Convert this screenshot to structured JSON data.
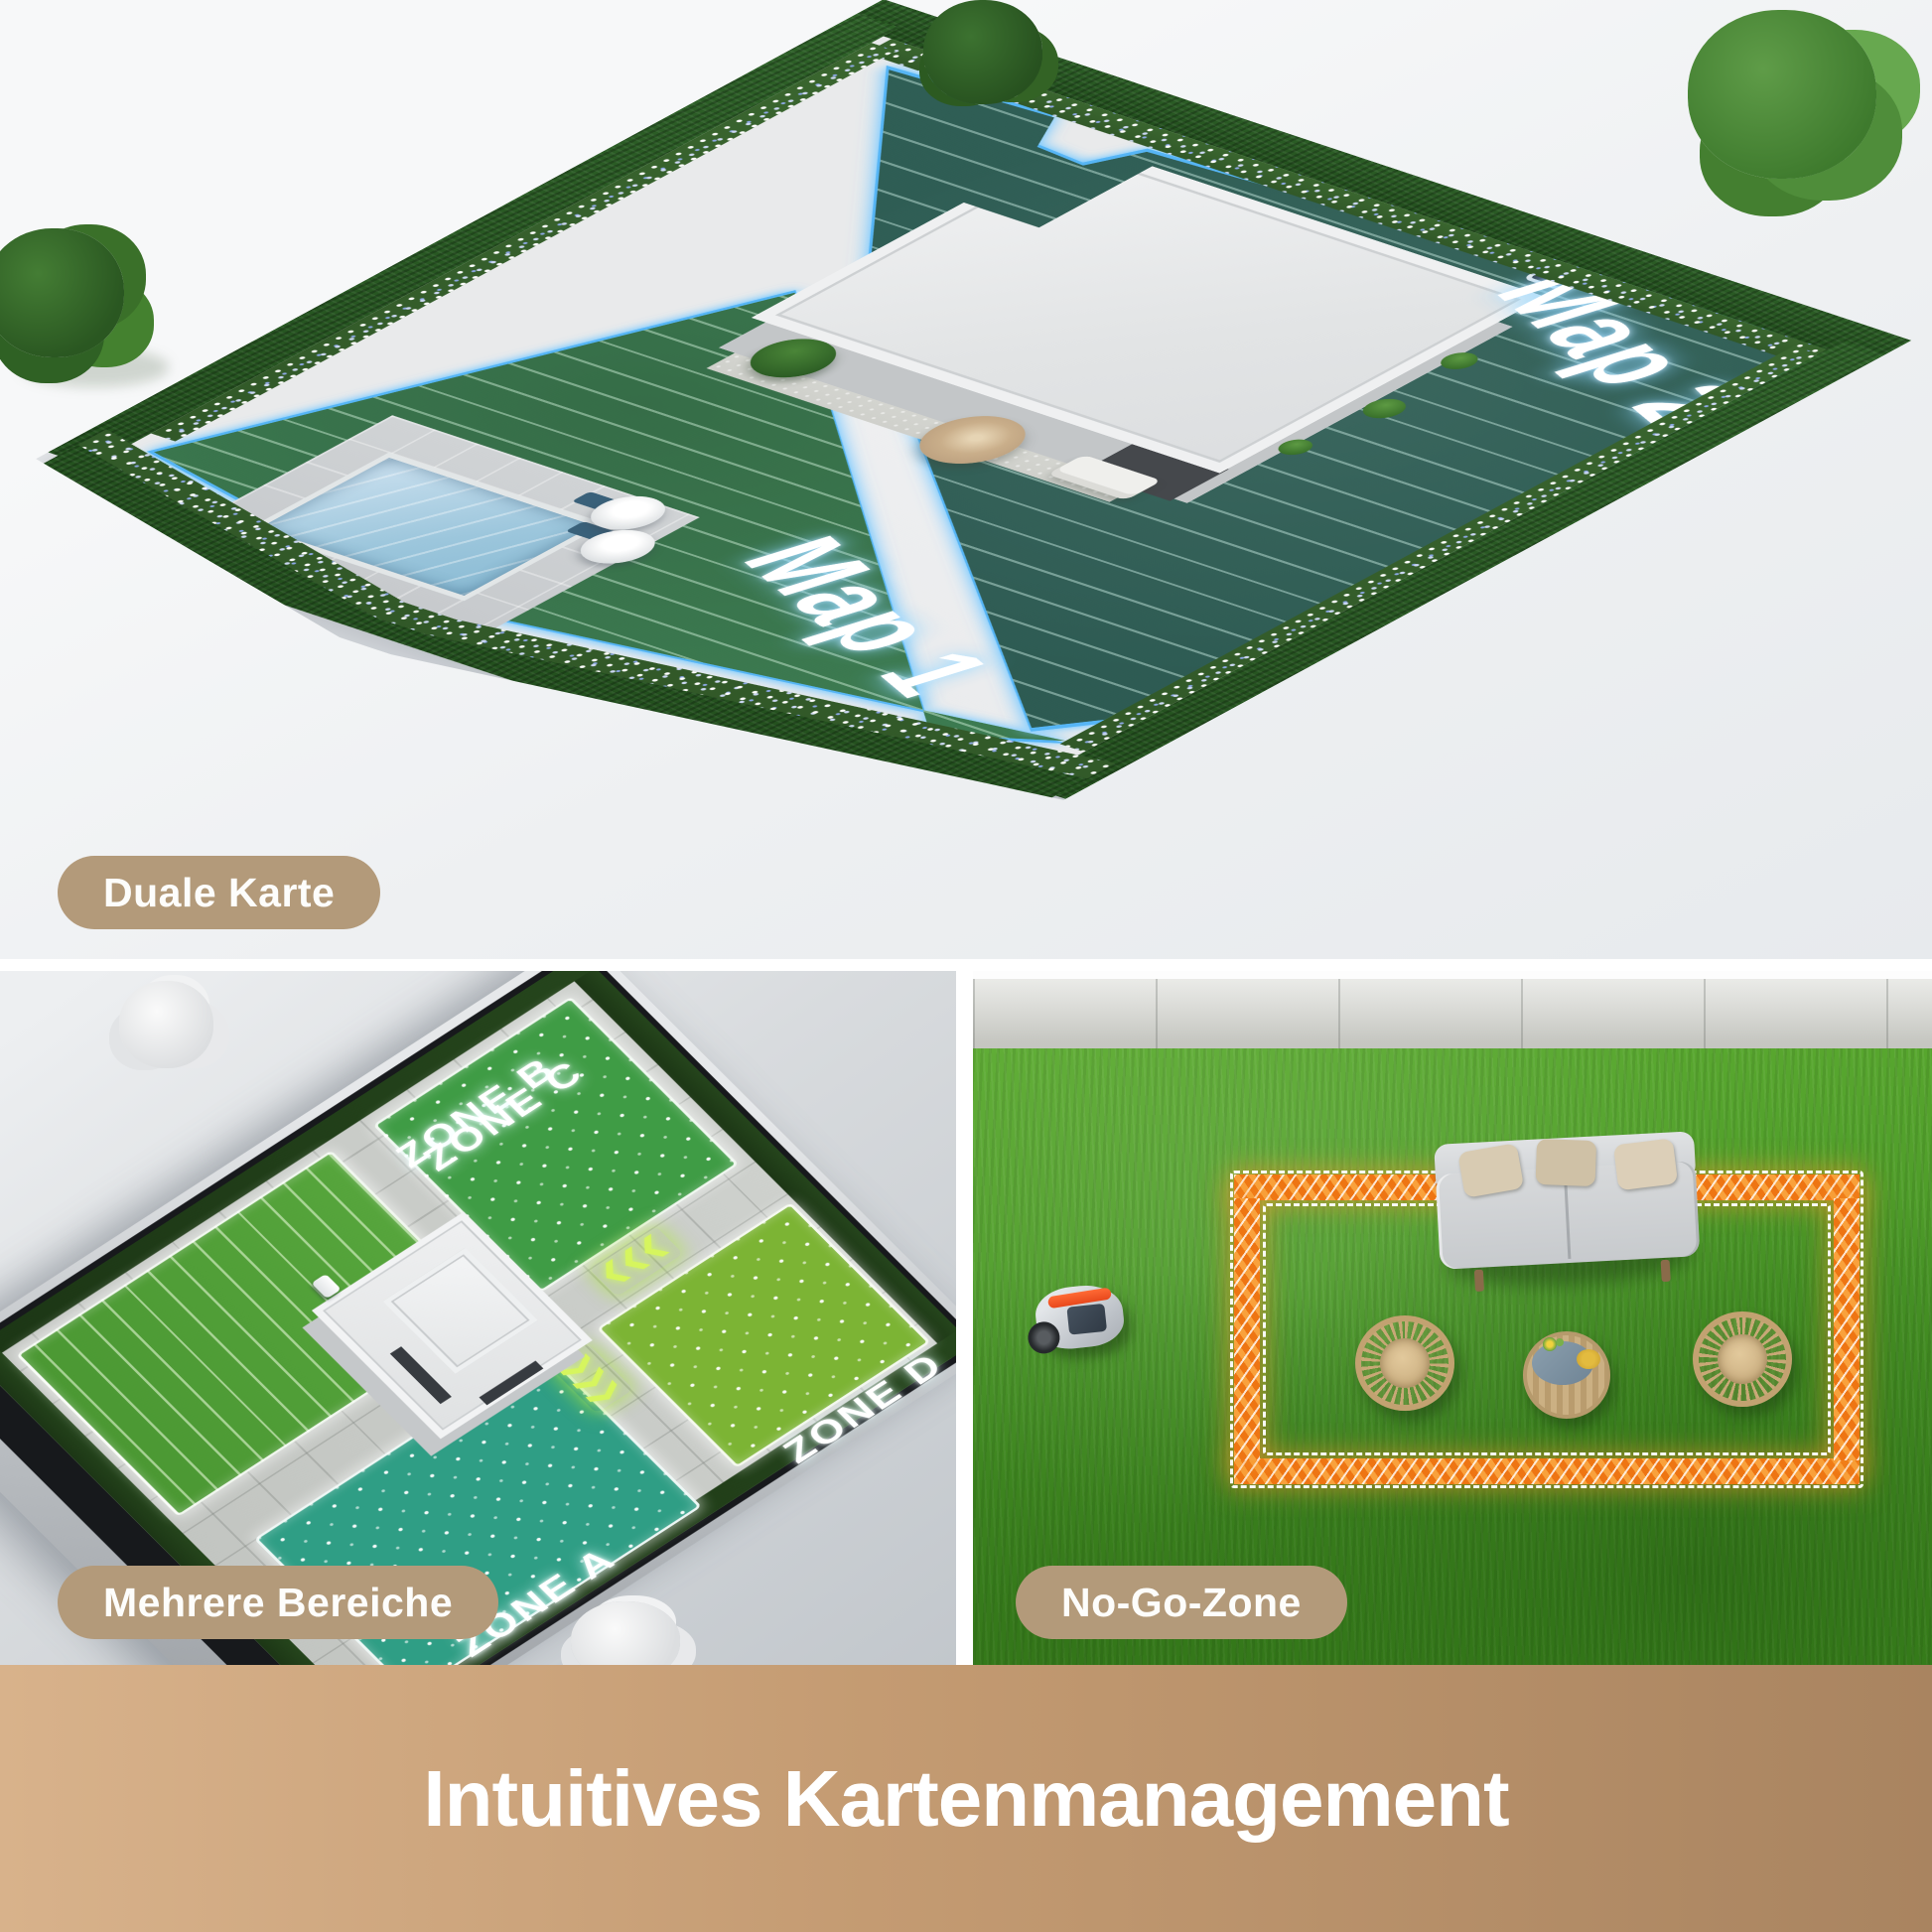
{
  "panels": {
    "dual_map": {
      "badge_label": "Duale Karte",
      "map1_label": "Map 1",
      "map2_label": "Map 2"
    },
    "multi_zone": {
      "badge_label": "Mehrere Bereiche",
      "zone_a": "ZONE A",
      "zone_b": "ZONE B",
      "zone_c": "ZONE C",
      "zone_d": "ZONE D"
    },
    "no_go": {
      "badge_label": "No-Go-Zone"
    }
  },
  "footer": {
    "title": "Intuitives Kartenmanagement"
  },
  "icons": {
    "chevron_gate": "❯❯❯"
  },
  "colors": {
    "accent_blue": "#56b5f5",
    "nogo_orange": "#f07c1c",
    "badge_tan": "#b39a7a",
    "footer_gradient_left": "#d8b28b",
    "footer_gradient_right": "#a98460",
    "map1_green": "#3c7a50",
    "map2_teal": "#2d5a52",
    "zone_a_teal": "#2f9e85",
    "zone_b_green": "#56a53c",
    "zone_c_green": "#3f9c45",
    "zone_d_lime": "#7cb434",
    "grass_green": "#4a9827"
  }
}
